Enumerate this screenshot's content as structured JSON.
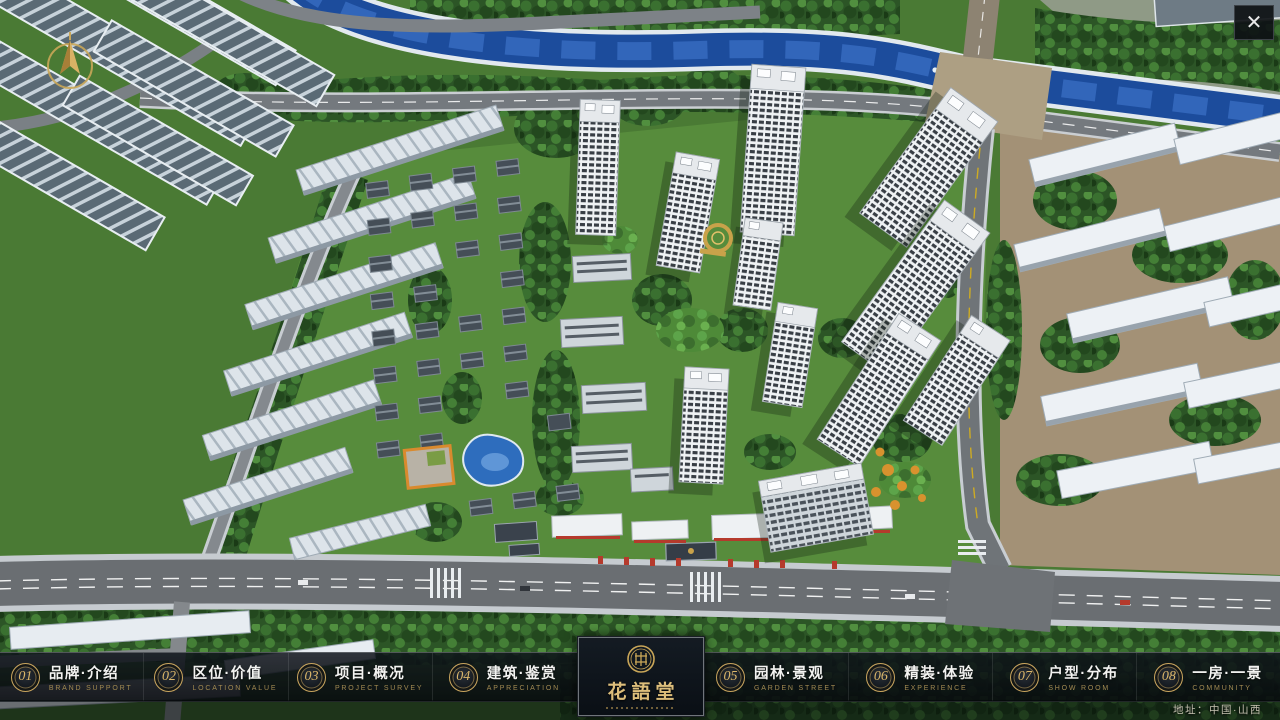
{
  "ui": {
    "close_glyph": "✕",
    "address": "地址：中国·山西"
  },
  "logo": {
    "name": "花語堂"
  },
  "nav": {
    "items": [
      {
        "num": "01",
        "label": "品牌·介绍",
        "sub": "BRAND SUPPORT"
      },
      {
        "num": "02",
        "label": "区位·价值",
        "sub": "LOCATION VALUE"
      },
      {
        "num": "03",
        "label": "项目·概况",
        "sub": "PROJECT SURVEY"
      },
      {
        "num": "04",
        "label": "建筑·鉴赏",
        "sub": "APPRECIATION"
      },
      {
        "num": "05",
        "label": "园林·景观",
        "sub": "GARDEN STREET"
      },
      {
        "num": "06",
        "label": "精装·体验",
        "sub": "EXPERIENCE"
      },
      {
        "num": "07",
        "label": "户型·分布",
        "sub": "SHOW ROOM"
      },
      {
        "num": "08",
        "label": "一房·一景",
        "sub": "COMMUNITY"
      }
    ]
  },
  "colors": {
    "gold": "#c9a55e",
    "bar_bg": "#0a0f15",
    "river": "#1c4c9c",
    "tree_green": "#2c5526",
    "accent_red": "#b53a2c"
  }
}
